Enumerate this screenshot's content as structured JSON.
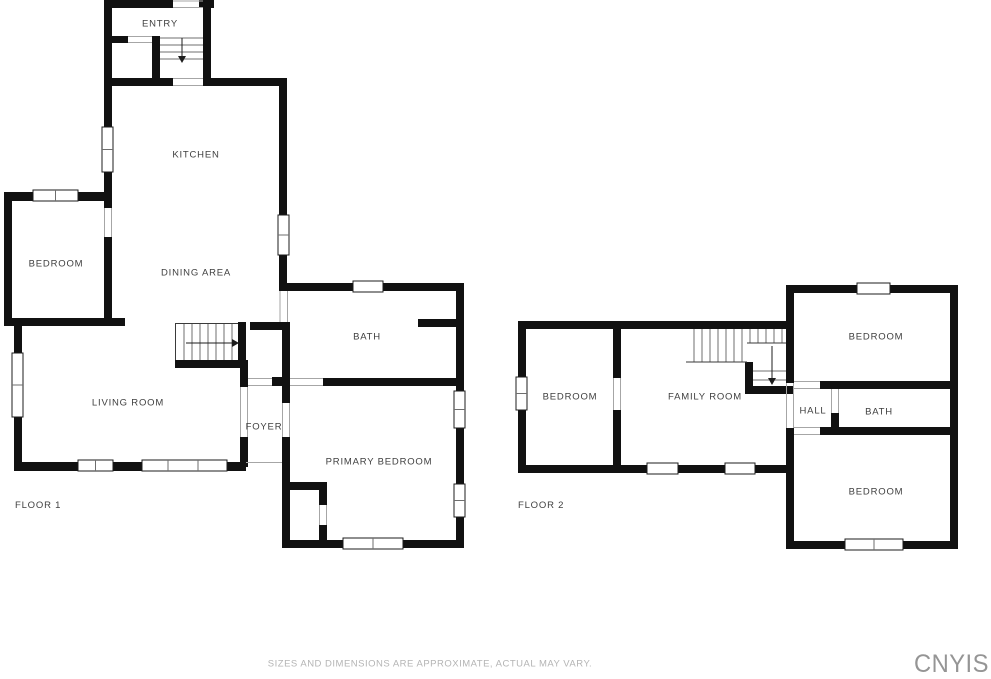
{
  "colors": {
    "background": "#ffffff",
    "wall": "#111111",
    "label": "#3f3f3f",
    "door_jamb": "#a6a6a6",
    "stair_line": "#6f6f6f",
    "disclaimer": "#b4b4b4",
    "watermark": "#959595"
  },
  "floor1": {
    "label": "FLOOR 1",
    "rooms": {
      "entry": "ENTRY",
      "kitchen": "KITCHEN",
      "bedroom": "BEDROOM",
      "dining_area": "DINING AREA",
      "bath": "BATH",
      "living_room": "LIVING ROOM",
      "foyer": "FOYER",
      "primary_bedroom": "PRIMARY BEDROOM"
    }
  },
  "floor2": {
    "label": "FLOOR 2",
    "rooms": {
      "bedroom_left": "BEDROOM",
      "family_room": "FAMILY ROOM",
      "hall": "HALL",
      "bath": "BATH",
      "bedroom_top": "BEDROOM",
      "bedroom_bottom": "BEDROOM"
    }
  },
  "footer": {
    "disclaimer": "SIZES AND DIMENSIONS ARE APPROXIMATE, ACTUAL MAY VARY.",
    "watermark": "CNYIS"
  }
}
